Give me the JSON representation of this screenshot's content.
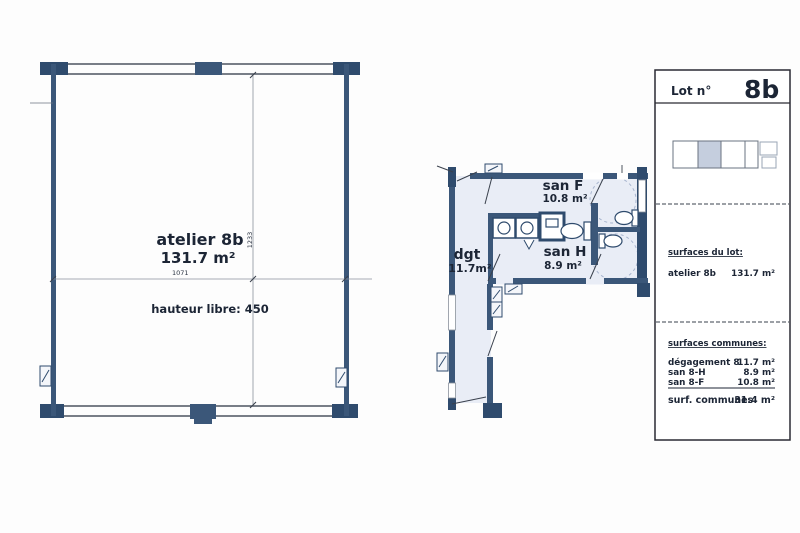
{
  "colors": {
    "wall_navy": "#3b5779",
    "pillar_navy": "#2f4b6d",
    "wall_line": "#4d5560",
    "dim_line": "#6a7280",
    "floor_tint": "#e9edf6",
    "dashed_circle": "#a9b6cf",
    "text_ink": "#1c2535",
    "key_shade": "#c5cede"
  },
  "atelier_plan": {
    "name_label": "atelier 8b",
    "area_label": "131.7 m²",
    "width_dim": "1071",
    "height_dim": "1233",
    "height_note": "hauteur libre: 450"
  },
  "san_plan": {
    "dgt_label": "dgt",
    "dgt_area": "11.7m²",
    "sanf_label": "san F",
    "sanf_area": "10.8 m²",
    "sanh_label": "san H",
    "sanh_area": "8.9 m²"
  },
  "panel": {
    "lot_label": "Lot n°",
    "lot_number": "8b",
    "surfaces_lot_title": "surfaces du lot:",
    "lot_rows": [
      {
        "label": "atelier  8b",
        "value": "131.7 m²"
      }
    ],
    "surfaces_communes_title": "surfaces communes:",
    "commune_rows": [
      {
        "label": "dégagement 8",
        "value": "11.7 m²"
      },
      {
        "label": "san 8-H",
        "value": "8.9 m²"
      },
      {
        "label": "san 8-F",
        "value": "10.8 m²"
      }
    ],
    "total_label": "surf. communes",
    "total_value": "31.4 m²"
  }
}
